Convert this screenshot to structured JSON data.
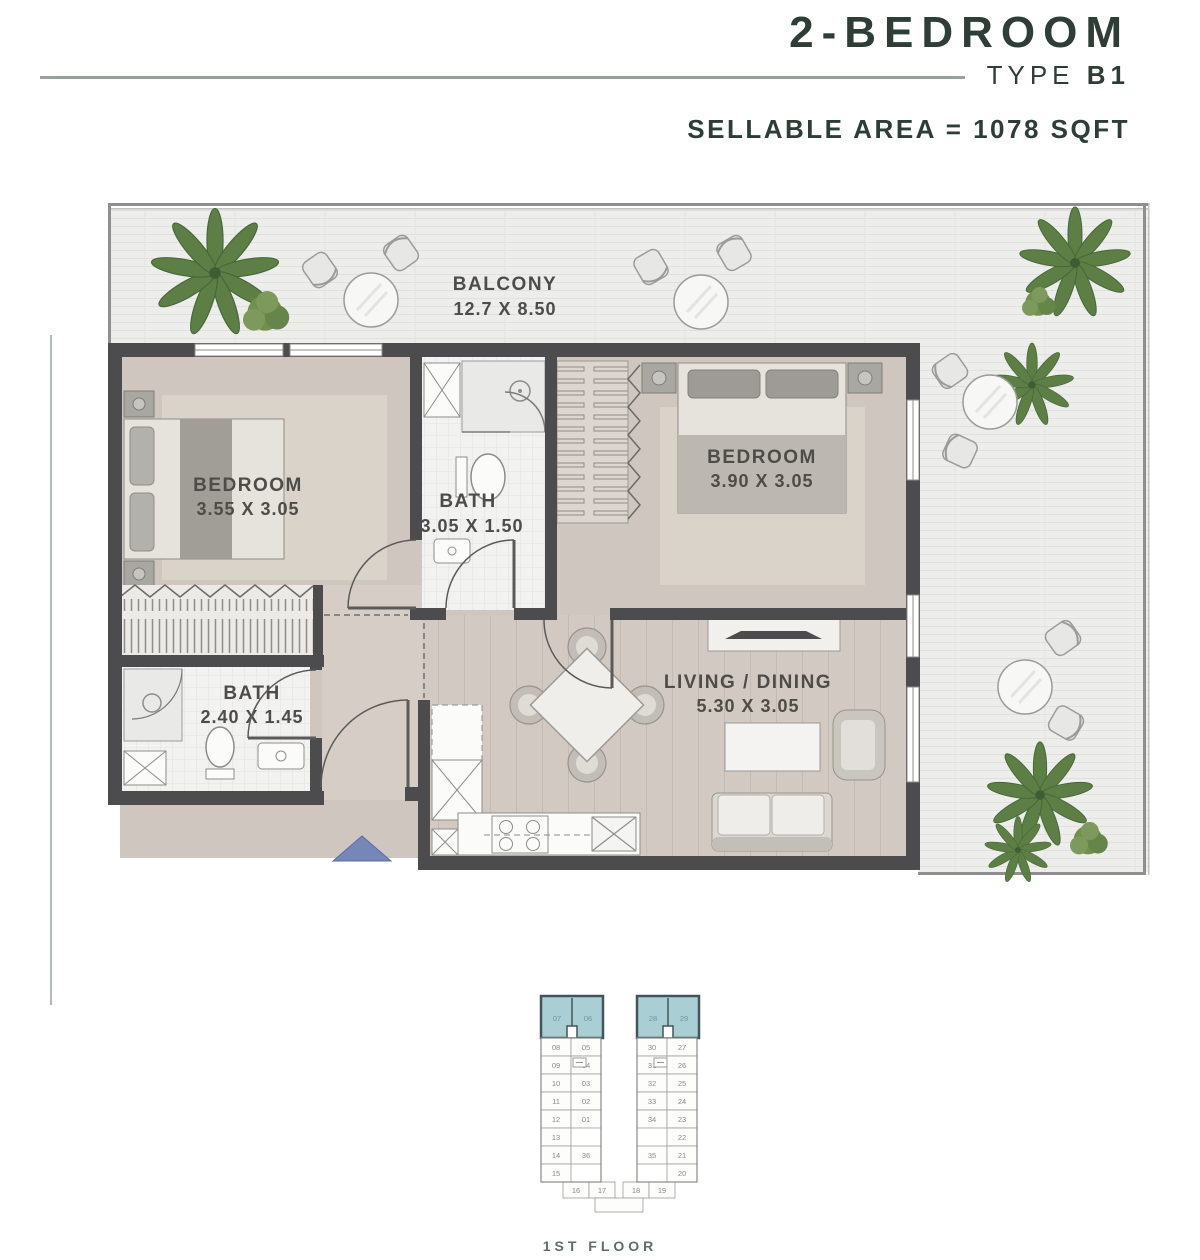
{
  "header": {
    "title": "2-BEDROOM",
    "type_label": "TYPE ",
    "type_value": "B1",
    "area_label": "SELLABLE AREA = 1078 SQFT"
  },
  "plan": {
    "balcony": {
      "name": "BALCONY",
      "dims": "12.7 X 8.50"
    },
    "bedroom1": {
      "name": "BEDROOM",
      "dims": "3.55 X 3.05"
    },
    "bath1": {
      "name": "BATH",
      "dims": "3.05 X 1.50"
    },
    "bedroom2": {
      "name": "BEDROOM",
      "dims": "3.90 X 3.05"
    },
    "bath2": {
      "name": "BATH",
      "dims": "2.40 X 1.45"
    },
    "living": {
      "name": "LIVING / DINING",
      "dims": "5.30 X 3.05"
    }
  },
  "keyplan": {
    "floor_label": "1ST FLOOR",
    "highlighted_left": [
      "07",
      "06"
    ],
    "highlighted_right": [
      "28",
      "29"
    ],
    "left_outer": [
      "08",
      "09",
      "10",
      "11",
      "12",
      "13",
      "14",
      "15"
    ],
    "left_inner": [
      "05",
      "04",
      "03",
      "02",
      "01",
      "36"
    ],
    "right_inner": [
      "30",
      "31",
      "32",
      "33",
      "34",
      "35"
    ],
    "right_outer": [
      "27",
      "26",
      "25",
      "24",
      "23",
      "22",
      "21",
      "20"
    ],
    "bottom_left": [
      "16",
      "17"
    ],
    "bottom_right": [
      "18",
      "19"
    ]
  },
  "colors": {
    "title_text": "#2e3d36",
    "divider": "#97a39c",
    "wall": "#4c4b4d",
    "floor_beige": "#cfc7bf",
    "floor_rug": "#d9d3ca",
    "bath_white": "#f2f2f0",
    "terrace": "#ededeb",
    "palm_green": "#5d7f45",
    "keyplan_highlight": "#a9ced4",
    "entry_arrow_blue": "#7487b8"
  }
}
